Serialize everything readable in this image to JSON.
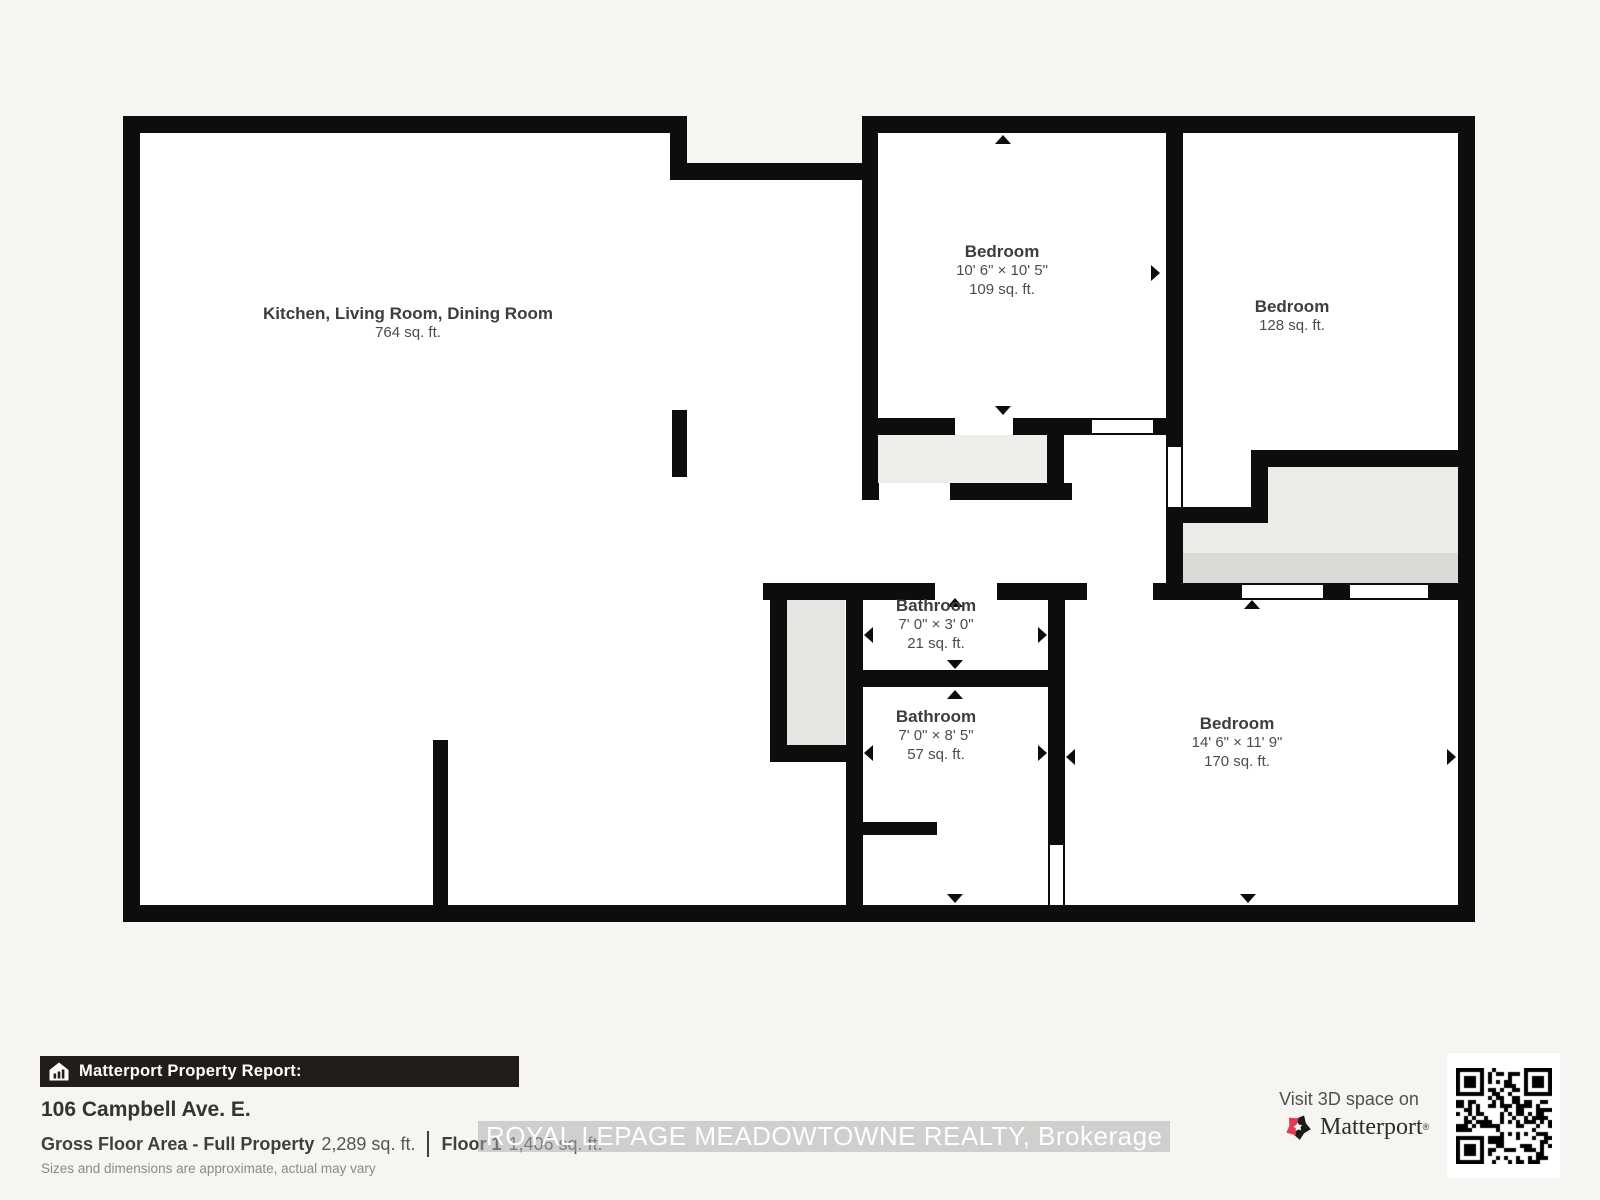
{
  "colors": {
    "wall": "#0d0d0d",
    "page_background": "#f6f5f2",
    "stairs_light": "#eeece9",
    "stairs_dark": "#dbdad7",
    "closet_gray": "#f0eeeb",
    "accent_red": "#e23a50"
  },
  "floorplan": {
    "rooms": [
      {
        "id": "kitchen-living-dining",
        "name": "Kitchen, Living Room, Dining Room",
        "area": "764 sq. ft."
      },
      {
        "id": "bedroom-top-middle",
        "name": "Bedroom",
        "dimensions": "10' 6\" × 10' 5\"",
        "area": "109 sq. ft."
      },
      {
        "id": "bedroom-top-right",
        "name": "Bedroom",
        "area": "128 sq. ft."
      },
      {
        "id": "bathroom-small",
        "name": "Bathroom",
        "dimensions": "7' 0\" × 3' 0\"",
        "area": "21 sq. ft."
      },
      {
        "id": "bathroom-main",
        "name": "Bathroom",
        "dimensions": "7' 0\" × 8' 5\"",
        "area": "57 sq. ft."
      },
      {
        "id": "bedroom-bottom-right",
        "name": "Bedroom",
        "dimensions": "14' 6\" × 11' 9\"",
        "area": "170 sq. ft."
      }
    ]
  },
  "report": {
    "banner_label": "Matterport Property Report:",
    "address": "106 Campbell Ave. E.",
    "gross_floor_label": "Gross Floor Area - Full Property",
    "gross_floor_value": "2,289 sq. ft.",
    "floor_label": "Floor 1",
    "floor_value": "1,406 sq. ft.",
    "disclaimer": "Sizes and dimensions are approximate, actual may vary"
  },
  "watermark": {
    "text": "ROYAL LEPAGE MEADOWTOWNE REALTY, Brokerage"
  },
  "cta": {
    "visit_text": "Visit 3D space on",
    "brand": "Matterport",
    "trademark": "®"
  }
}
